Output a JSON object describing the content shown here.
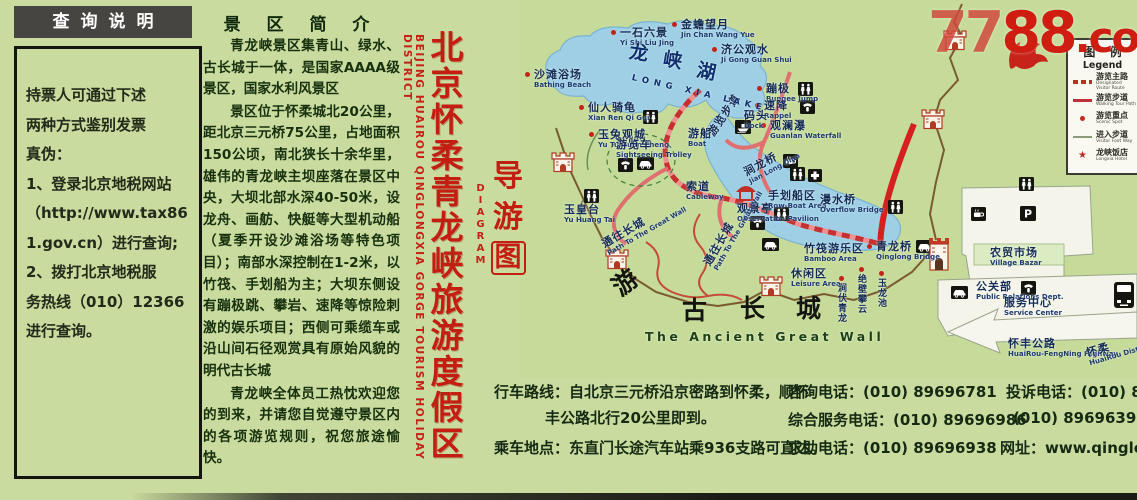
{
  "watermark": {
    "part_light": "77",
    "part_dark": "88",
    "part_suffix": ".com"
  },
  "left_panel": {
    "title": "查询说明",
    "lines": [
      "持票人可通过下述",
      "两种方式鉴别发票",
      "真伪：",
      "1、登录北京地税网站",
      "（http://www.tax86",
      "1.gov.cn）进行查询;",
      "2、拨打北京地税服",
      "务热线（010）12366",
      "进行查询。"
    ]
  },
  "intro": {
    "title": "景 区 简 介",
    "paragraphs": [
      "青龙峡景区集青山、绿水、古长城于一体，是国家AAAA级景区，国家水利风景区",
      "景区位于怀柔城北20公里，距北京三元桥75公里，占地面积150公顷，南北狭长十余华里，雄伟的青龙峡主坝座落在景区中央，大坝北部水深40-50米，设龙舟、画舫、快艇等大型机动船（夏季开设沙滩浴场等特色项目）；南部水深控制在1-2米，以竹筏、手划船为主；大坝东侧设有蹦极跳、攀岩、速降等惊险刺激的娱乐项目；西侧可乘缆车或沿山间石径观赏具有原始风貌的明代古长城",
      "青龙峡全体员工热忱欢迎您的到来，并请您自觉遵守景区内的各项游览规则，祝您旅途愉快。"
    ]
  },
  "banner": {
    "cn": "北京怀柔青龙峡旅游度假区",
    "en": "BEIJING HUAIROU QINGLONGXIA GORGE TOURISM HOLIDAY DISTRICT"
  },
  "guide": {
    "ch1": "导",
    "ch2": "游",
    "ch3": "图",
    "en": "DIAGRAM"
  },
  "map": {
    "legend": {
      "title_cn": "图 例",
      "title_en": "Legend",
      "items": [
        {
          "sw": "sw-dash",
          "cn": "游览主路",
          "en": "Designated Visitor Route"
        },
        {
          "sw": "sw-line",
          "cn": "游览步道",
          "en": "Walking Tour Path"
        },
        {
          "sw": "sw-dot",
          "cn": "游览重点",
          "en": "Scenic Spot"
        },
        {
          "sw": "sw-thin",
          "cn": "进入步道",
          "en": "Visitor Foot Way"
        },
        {
          "sw": "sw-star",
          "cn": "龙峡饭店",
          "en": "Longxia Hotel"
        }
      ]
    },
    "spots": [
      {
        "t": "dot",
        "cn": "一石六景",
        "en": "Yi Shi Liu Jing",
        "x": 620,
        "y": 27
      },
      {
        "t": "dot",
        "cn": "金蟾望月",
        "en": "Jin Chan Wang Yue",
        "x": 681,
        "y": 19
      },
      {
        "t": "dot",
        "cn": "济公观水",
        "en": "Ji Gong Guan Shui",
        "x": 721,
        "y": 44
      },
      {
        "t": "dot",
        "cn": "沙滩浴场",
        "en": "Bathing Beach",
        "x": 534,
        "y": 69
      },
      {
        "t": "dot",
        "cn": "仙人骑龟",
        "en": "Xian Ren Qi Gui",
        "x": 588,
        "y": 102
      },
      {
        "t": "dot",
        "cn": "玉兔观城",
        "en": "Yu Tu Guan Cheng",
        "x": 598,
        "y": 129
      },
      {
        "t": "dot",
        "cn": "蹦极",
        "en": "Bungee Jump",
        "x": 766,
        "y": 83
      },
      {
        "t": "dot",
        "cn": "速降",
        "en": "Rappel",
        "x": 764,
        "y": 100
      },
      {
        "t": "dot",
        "cn": "观澜瀑",
        "en": "Guanlan Waterfall",
        "x": 770,
        "y": 120
      },
      {
        "t": "plain",
        "cn": "码头",
        "en": "Dock",
        "x": 744,
        "y": 110
      },
      {
        "t": "plain",
        "cn": "游船",
        "en": "Boat",
        "x": 688,
        "y": 128
      },
      {
        "t": "plain",
        "cn": "游览车",
        "en": "Sightseeing Trolley",
        "x": 616,
        "y": 139
      },
      {
        "t": "plain",
        "cn": "索道",
        "en": "Cableway",
        "x": 686,
        "y": 181
      },
      {
        "t": "plain",
        "cn": "观景亭",
        "en": "Observation Pavilion",
        "x": 737,
        "y": 203
      },
      {
        "t": "plain",
        "cn": "玉皇台",
        "en": "Yu Huang Tai",
        "x": 564,
        "y": 204
      },
      {
        "t": "rot",
        "cn": "涧龙桥",
        "en": "Jian Long Qiao",
        "x": 742,
        "y": 168,
        "rot": -28
      },
      {
        "t": "plain",
        "cn": "手划船区",
        "en": "Row-Boat Area",
        "x": 768,
        "y": 190
      },
      {
        "t": "plain",
        "cn": "漫水桥",
        "en": "Overflow Bridge",
        "x": 820,
        "y": 194
      },
      {
        "t": "plain",
        "cn": "竹筏游乐区",
        "en": "Bamboo Area",
        "x": 804,
        "y": 243
      },
      {
        "t": "dot",
        "cn": "青龙桥",
        "en": "Qinglong Bridge",
        "x": 876,
        "y": 241
      },
      {
        "t": "plain",
        "cn": "休闲区",
        "en": "Leisure Area",
        "x": 791,
        "y": 268
      },
      {
        "t": "vert",
        "cn": "涧伏青龙",
        "x": 836,
        "y": 276
      },
      {
        "t": "vert",
        "cn": "绝壁攀云",
        "x": 856,
        "y": 267
      },
      {
        "t": "vert",
        "cn": "玉龙池",
        "x": 876,
        "y": 271
      },
      {
        "t": "rot",
        "cn": "通往长城",
        "en": "Path To The Great Wall",
        "x": 600,
        "y": 240,
        "rot": -30
      },
      {
        "t": "rot",
        "cn": "通往长城",
        "en": "Path To The Great Wall",
        "x": 702,
        "y": 262,
        "rot": -60
      },
      {
        "t": "rot",
        "cn": "游览步道",
        "x": 706,
        "y": 132,
        "rot": -56
      },
      {
        "t": "plain",
        "cn": "农贸市场",
        "en": "Village Bazar",
        "x": 990,
        "y": 247
      },
      {
        "t": "plain",
        "cn": "公关部",
        "en": "Public Relations Dept.",
        "x": 976,
        "y": 281
      },
      {
        "t": "plain",
        "cn": "服务中心",
        "en": "Service Center",
        "x": 1004,
        "y": 297
      },
      {
        "t": "plain",
        "cn": "怀丰公路",
        "en": "HuaiRou-FengNing Highway",
        "x": 1008,
        "y": 338
      },
      {
        "t": "rot",
        "cn": "怀柔",
        "en": "HuaiRou District",
        "x": 1085,
        "y": 348,
        "rot": -16
      },
      {
        "t": "lake",
        "cn": "龙",
        "x": 630,
        "y": 47,
        "rot": 8
      },
      {
        "t": "lake",
        "cn": "峡",
        "x": 664,
        "y": 54,
        "rot": 10
      },
      {
        "t": "lake",
        "cn": "湖",
        "x": 698,
        "y": 65,
        "rot": 12
      },
      {
        "t": "lakeen",
        "en": "LONG XIA LAKE",
        "x": 633,
        "y": 73,
        "rot": 13
      },
      {
        "t": "big",
        "cn": "游",
        "x": 612,
        "y": 286,
        "rot": -38
      },
      {
        "t": "big",
        "cn": "古",
        "x": 682,
        "y": 305
      },
      {
        "t": "big",
        "cn": "长",
        "x": 740,
        "y": 303
      },
      {
        "t": "big",
        "cn": "城",
        "x": 796,
        "y": 303
      },
      {
        "t": "bigen",
        "en": "The Ancient Great Wall",
        "x": 645,
        "y": 332
      }
    ],
    "icons": [
      {
        "t": "wc",
        "x": 643,
        "y": 110
      },
      {
        "t": "wc",
        "x": 798,
        "y": 82
      },
      {
        "t": "phone",
        "x": 800,
        "y": 100
      },
      {
        "t": "wc",
        "x": 790,
        "y": 167
      },
      {
        "t": "firstaid",
        "x": 808,
        "y": 169
      },
      {
        "t": "wc",
        "x": 774,
        "y": 207
      },
      {
        "t": "phone",
        "x": 750,
        "y": 216
      },
      {
        "t": "coffee",
        "x": 783,
        "y": 154
      },
      {
        "t": "car",
        "x": 762,
        "y": 238
      },
      {
        "t": "wc",
        "x": 888,
        "y": 200
      },
      {
        "t": "car",
        "x": 916,
        "y": 240
      },
      {
        "t": "boat",
        "x": 735,
        "y": 120
      },
      {
        "t": "phone",
        "x": 618,
        "y": 158
      },
      {
        "t": "car",
        "x": 637,
        "y": 157
      },
      {
        "t": "wc",
        "x": 1019,
        "y": 177
      },
      {
        "t": "parking",
        "x": 1020,
        "y": 206
      },
      {
        "t": "coffee",
        "x": 971,
        "y": 207
      },
      {
        "t": "phone",
        "x": 1021,
        "y": 281
      },
      {
        "t": "car",
        "x": 951,
        "y": 286
      },
      {
        "t": "bus",
        "x": 1113,
        "y": 281
      },
      {
        "t": "wc",
        "x": 584,
        "y": 189
      },
      {
        "t": "tower",
        "x": 550,
        "y": 150
      },
      {
        "t": "tower",
        "x": 604,
        "y": 247
      },
      {
        "t": "tower",
        "x": 758,
        "y": 274
      },
      {
        "t": "tower",
        "x": 942,
        "y": 28
      },
      {
        "t": "tower",
        "x": 920,
        "y": 107
      },
      {
        "t": "gate",
        "x": 927,
        "y": 236
      },
      {
        "t": "pavilion",
        "x": 735,
        "y": 184
      }
    ]
  },
  "footer": {
    "drive_label": "行车路线：",
    "drive_line1": "自北京三元桥沿京密路到怀柔，顺怀",
    "drive_line2": "丰公路北行20公里即到。",
    "bus_label": "乘车地点：",
    "bus_text": "东直门长途汽车站乘936支路可直达。",
    "phones": [
      {
        "a": "咨询电话：(010) 89696781",
        "ax": 788,
        "b": "投诉电话：(010) 8969669",
        "bx": 1006,
        "y": 381
      },
      {
        "a": "综合服务电话：(010) 89696986",
        "ax": 788,
        "b": "(010) 89696391",
        "bx": 1013,
        "y": 409
      },
      {
        "a": "求助电话：(010) 89696938",
        "ax": 788,
        "b": "网址：www.qinglongxia.cn",
        "bx": 1000,
        "y": 437
      }
    ]
  }
}
